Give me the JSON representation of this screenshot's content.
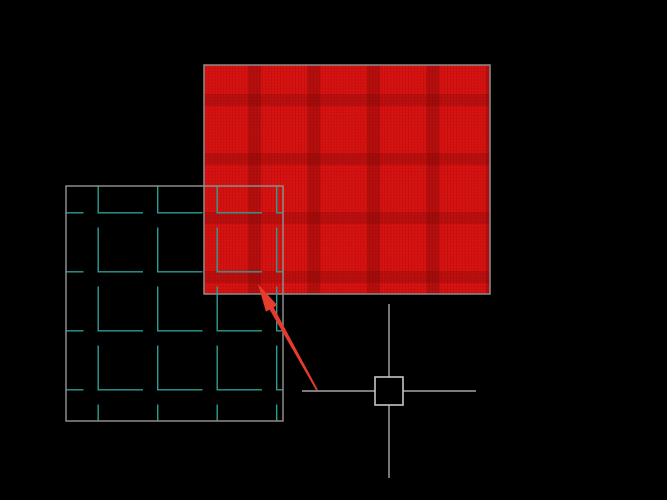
{
  "app": {
    "description": "CAD model-space drawing canvas showing two hatched rectangle entities, a crosshair cursor with pickbox, and a red annotation arrow"
  },
  "canvas": {
    "width": 667,
    "height": 500,
    "background": "#000000"
  },
  "colors": {
    "background": "#000000",
    "entity_border": "#8c8c8c",
    "red_hatch_base": "#dc1210",
    "red_hatch_fine_line": "#9c0c0c",
    "red_hatch_band": "#6e0707",
    "teal_hatch_line": "#2b9e94",
    "crosshair": "#c6c6c6",
    "arrow": "#e73b2e"
  },
  "entities": {
    "red_hatch_rect": {
      "x": 204,
      "y": 65,
      "width": 286,
      "height": 229,
      "hatch_style": "dense-grid-fill",
      "band_period": 59.5
    },
    "teal_hatch_rect": {
      "x": 66,
      "y": 186,
      "width": 217,
      "height": 235,
      "hatch_style": "angle-L-tiles",
      "tile_period_x": 59.5,
      "tile_period_y": 59,
      "leg_length": 45
    },
    "crosshair": {
      "cx": 389,
      "cy": 391,
      "arm": 87,
      "pickbox": 28
    },
    "arrow": {
      "tip_x": 258,
      "tip_y": 284,
      "tail_x": 317,
      "tail_y": 390,
      "head_length": 28,
      "head_width": 13,
      "shaft_width": 4.6,
      "tail_width": 1.8
    }
  }
}
